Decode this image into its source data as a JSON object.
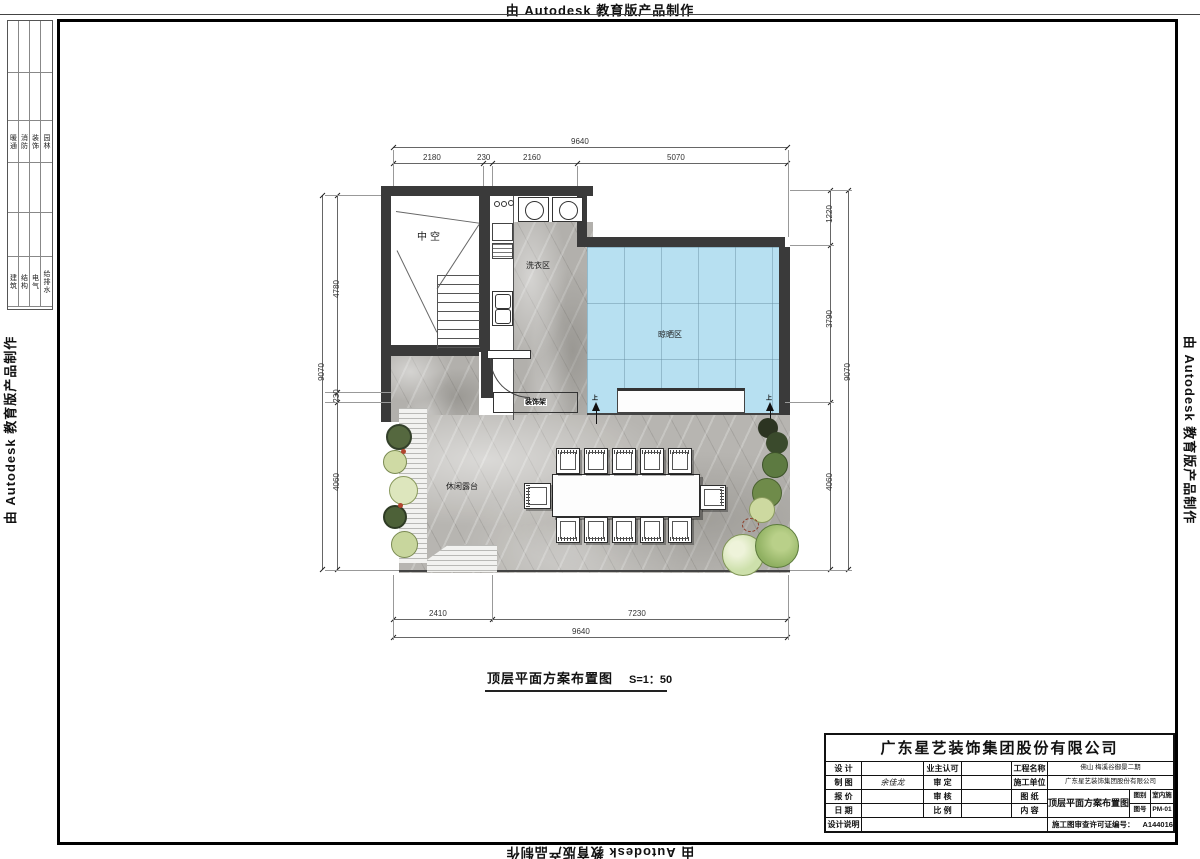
{
  "banner": {
    "top": "由 Autodesk 教育版产品制作",
    "bottom": "由 Autodesk 教育版产品制作",
    "left": "由 Autodesk 教育版产品制作",
    "right": "由 Autodesk 教育版产品制作"
  },
  "margin_table": {
    "disciplines_upper": [
      "暖通",
      "消防",
      "装饰",
      "园林"
    ],
    "disciplines_lower": [
      "建筑",
      "结构",
      "电气",
      "给排水"
    ]
  },
  "plan": {
    "labels": {
      "void": "中空",
      "laundry": "洗衣区",
      "drying": "晾晒区",
      "terrace": "休闲露台",
      "shelf": "装饰架",
      "up_marker": "上"
    },
    "colors": {
      "wall": "#3a3a3a",
      "drying_area": "#b7e0f1"
    }
  },
  "dimensions": {
    "top": {
      "overall": "9640",
      "seg1": "2180",
      "seg2": "230",
      "seg3": "2160",
      "seg4": "5070"
    },
    "bottom": {
      "overall": "9640",
      "seg1": "2410",
      "seg2": "7230"
    },
    "left": {
      "overall": "9070",
      "seg1": "4780",
      "seg2": "230",
      "seg3": "4060"
    },
    "right": {
      "overall": "9070",
      "seg1": "1220",
      "seg2": "3790",
      "seg3": "4060"
    }
  },
  "drawing_title": {
    "name": "顶层平面方案布置图",
    "scale": "S=1：50"
  },
  "title_block": {
    "company": "广东星艺装饰集团股份有限公司",
    "labels": {
      "design": "设 计",
      "drafting": "制 图",
      "quote": "报 价",
      "date": "日 期",
      "notes": "设计说明",
      "owner_approval": "业主认可",
      "approved": "审 定",
      "checked": "审 核",
      "scale": "比 例",
      "project_name": "工程名称",
      "contractor": "施工单位",
      "drawing": "图 纸",
      "content": "内 容",
      "category": "图别",
      "number": "图号",
      "permit": "施工图审查许可证编号："
    },
    "values": {
      "drafting": "余佳龙",
      "project_name": "佛山 梅溪谷御景二期",
      "contractor": "广东星艺装饰集团股份有限公司",
      "content": "顶层平面方案布置图",
      "category": "室内施",
      "number": "PM-01",
      "permit": "A144016621(甲级)"
    }
  }
}
